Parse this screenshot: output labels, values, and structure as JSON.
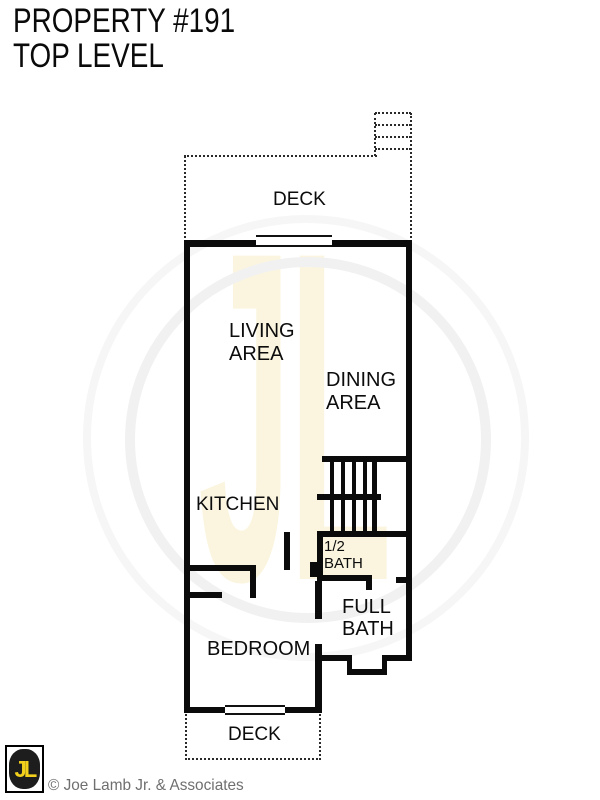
{
  "title": {
    "line1": "PROPERTY #191",
    "line2": "TOP LEVEL"
  },
  "rooms": {
    "top_deck": "DECK",
    "living_area": {
      "line1": "LIVING",
      "line2": "AREA"
    },
    "dining_area": {
      "line1": "DINING",
      "line2": "AREA"
    },
    "kitchen": "KITCHEN",
    "half_bath": {
      "line1": "1/2",
      "line2": "BATH"
    },
    "full_bath": {
      "line1": "FULL",
      "line2": "BATH"
    },
    "bedroom": "BEDROOM",
    "bottom_deck": "DECK"
  },
  "watermark": {
    "text": "JL"
  },
  "footer": {
    "logo_text": "JL",
    "copyright": "© Joe Lamb Jr. & Associates"
  },
  "colors": {
    "wall": "#0b0b0b",
    "label": "#0c0c0c",
    "copyright_gray": "#6f6f6f",
    "logo_yellow": "#f2d01c",
    "logo_black": "#1d1d1d",
    "watermark_cream": "#fbf5df",
    "watermark_ring": "#f1f1f1"
  }
}
